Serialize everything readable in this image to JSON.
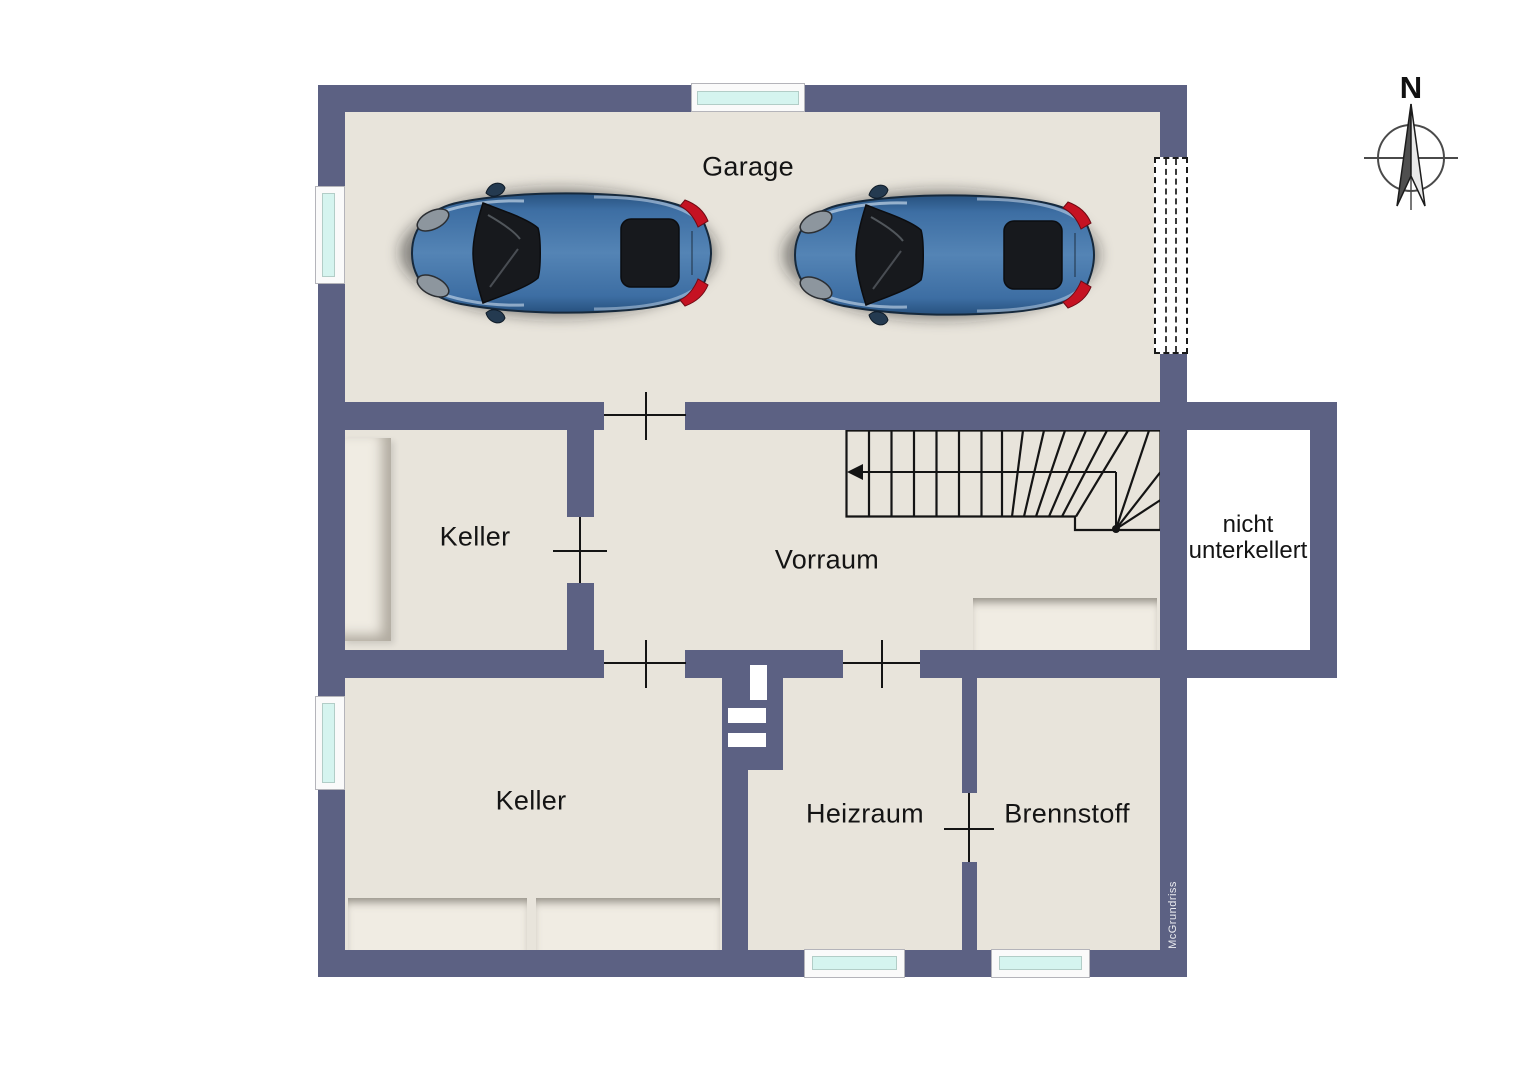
{
  "rooms": {
    "garage": "Garage",
    "keller_upper": "Keller",
    "vorraum": "Vorraum",
    "keller_lower": "Keller",
    "heizraum": "Heizraum",
    "brennstoff": "Brennstoff",
    "annex": "nicht unterkellert"
  },
  "compass": {
    "label": "N"
  },
  "watermark": "McGrundriss",
  "colors": {
    "wall": "#5c6183",
    "floor": "#e8e4db",
    "furniture": "#f0ece3",
    "window_glass": "#d5f4ef",
    "annex_floor": "#ffffff",
    "car_body": "#3d6ea3",
    "background": "#ffffff"
  }
}
